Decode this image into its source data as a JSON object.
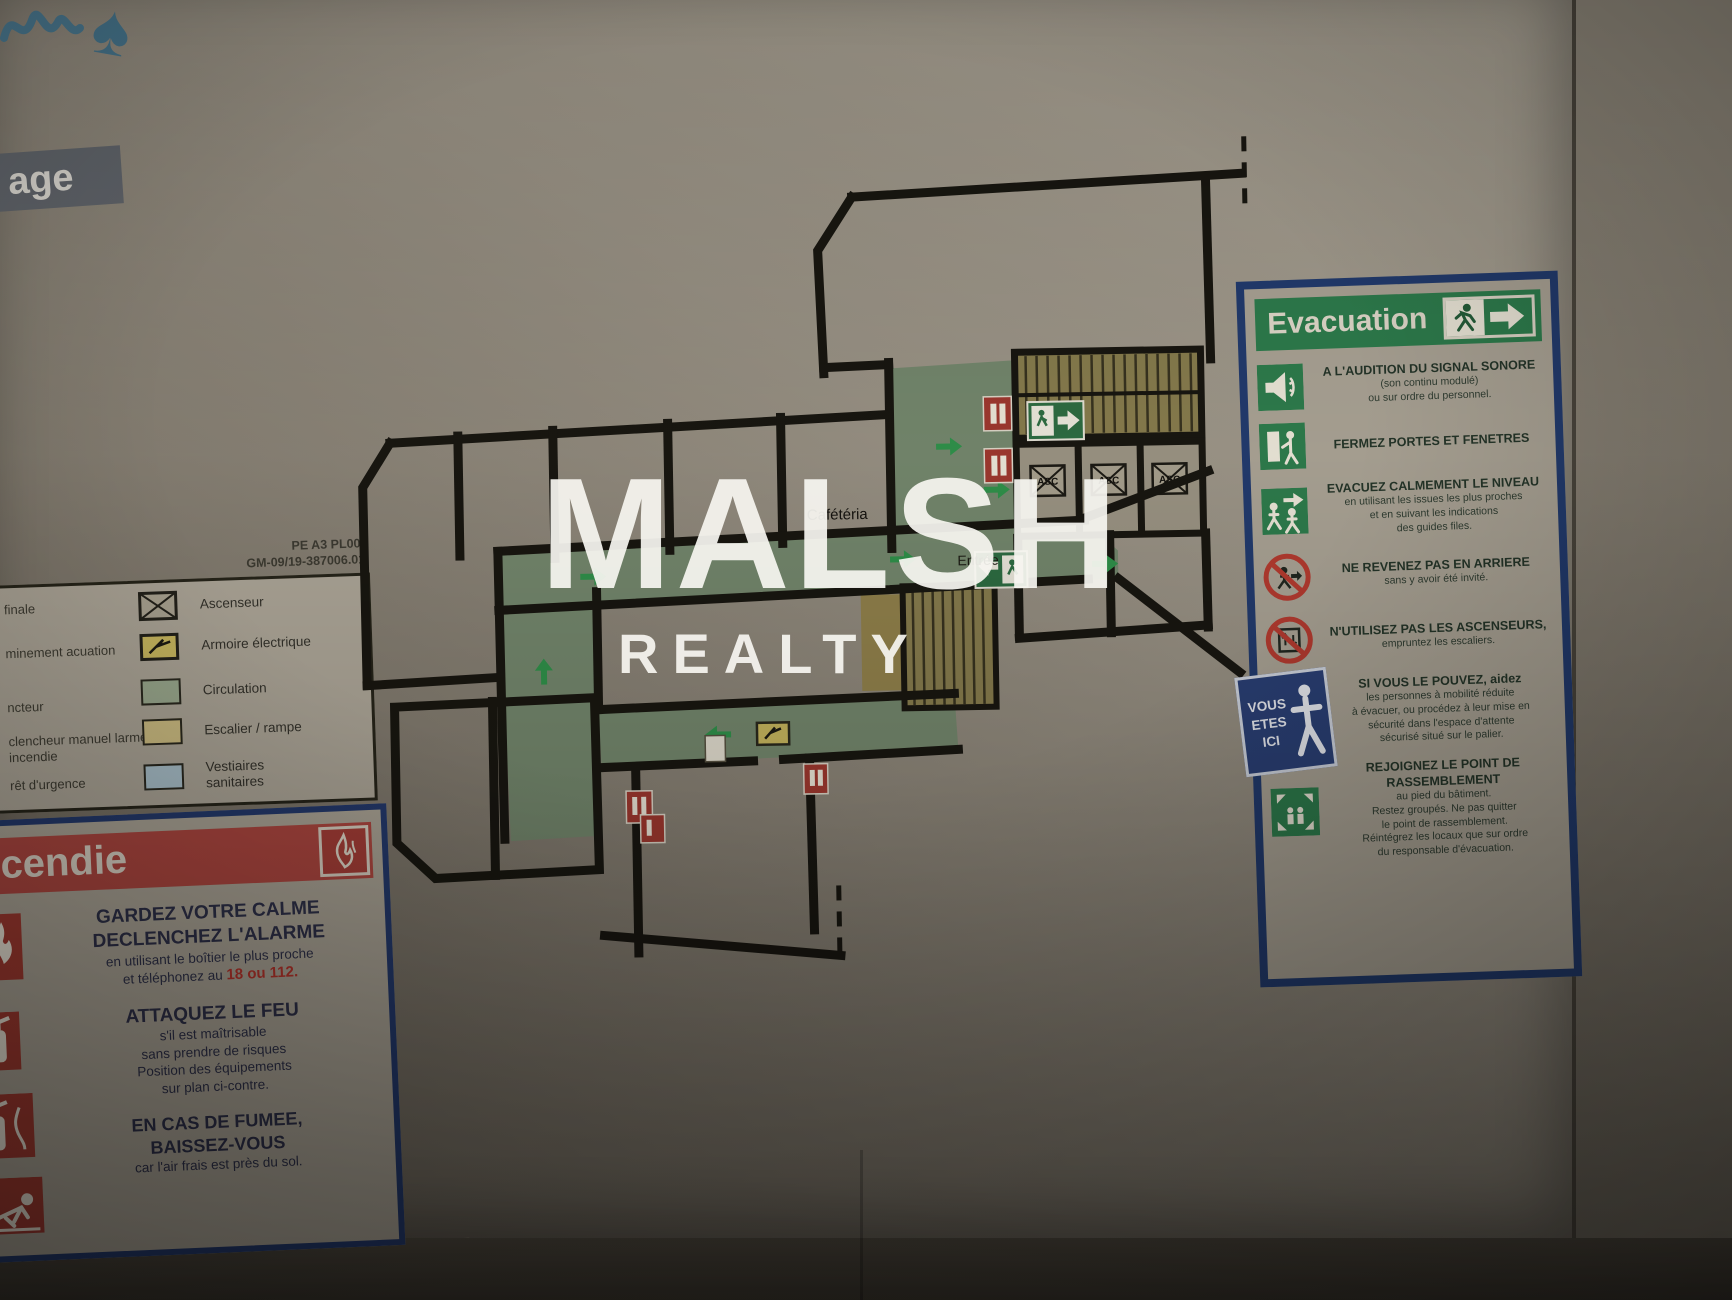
{
  "scene": {
    "floor_tab": "age",
    "watermark": {
      "line1": "MALSH",
      "line2": "REALTY"
    }
  },
  "plan": {
    "ref_line1": "PE A3 PL00-",
    "ref_line2": "GM-09/19-387006.01",
    "room_cafeteria": "Cafétéria",
    "room_entree": "Entrée",
    "elevator_abbr": "ASC",
    "you_are_here": {
      "l1": "VOUS",
      "l2": "ETES",
      "l3": "ICI"
    }
  },
  "legend": {
    "left_fragments": [
      "finale",
      "minement acuation",
      "ncteur",
      "clencheur manuel larme incendie",
      "rêt d'urgence"
    ],
    "items": [
      {
        "label": "Ascenseur"
      },
      {
        "label": "Armoire électrique"
      },
      {
        "label": "Circulation"
      },
      {
        "label": "Escalier / rampe"
      },
      {
        "label": "Vestiaires sanitaires"
      }
    ]
  },
  "fire_panel": {
    "title": "cendie",
    "s1_h1": "GARDEZ VOTRE CALME",
    "s1_h2": "DECLENCHEZ L'ALARME",
    "s1_b1": "en utilisant le boîtier le plus proche",
    "s1_b2": "et téléphonez au",
    "s1_phone": "18 ou 112.",
    "s2_h": "ATTAQUEZ LE FEU",
    "s2_b1": "s'il est maîtrisable",
    "s2_b2": "sans prendre de risques",
    "s2_b3": "Position des équipements",
    "s2_b4": "sur plan ci-contre.",
    "s3_h1": "EN CAS DE FUMEE,",
    "s3_h2": "BAISSEZ-VOUS",
    "s3_b": "car l'air frais est près du sol."
  },
  "evac_panel": {
    "title": "Evacuation",
    "items": [
      {
        "h": "A L'AUDITION DU SIGNAL SONORE",
        "lines": [
          "(son continu modulé)",
          "ou sur ordre du personnel."
        ]
      },
      {
        "h": "FERMEZ PORTES ET FENETRES",
        "lines": []
      },
      {
        "h": "EVACUEZ CALMEMENT LE NIVEAU",
        "lines": [
          "en utilisant les issues les plus proches",
          "et en suivant les indications",
          "des guides files."
        ]
      },
      {
        "h": "NE REVENEZ PAS EN ARRIERE",
        "lines": [
          "sans y avoir été invité."
        ]
      },
      {
        "h": "N'UTILISEZ PAS LES ASCENSEURS,",
        "lines": [
          "empruntez les escaliers."
        ]
      },
      {
        "h": "SI VOUS LE POUVEZ, aidez",
        "lines": [
          "les personnes à mobilité réduite",
          "à évacuer, ou procédez à leur mise en",
          "sécurité dans l'espace d'attente",
          "sécurisé situé sur le palier."
        ]
      },
      {
        "h": "REJOIGNEZ LE POINT DE RASSEMBLEMENT",
        "lines": [
          "au pied du bâtiment.",
          "Restez groupés. Ne pas quitter",
          "le point de rassemblement.",
          "Réintégrez les locaux que sur ordre",
          "du responsable d'évacuation."
        ]
      }
    ]
  },
  "colors": {
    "panel_border_navy": "#24396b",
    "fire_red": "#ac463f",
    "evac_green": "#2d7a4b",
    "plan_circulation_green": "#72856b",
    "plan_stairs_yellow": "#857a4c",
    "legend_sanitary_blue": "#a9bfc9",
    "you_are_here_blue": "#2a3f74",
    "wall_black": "#181610"
  }
}
